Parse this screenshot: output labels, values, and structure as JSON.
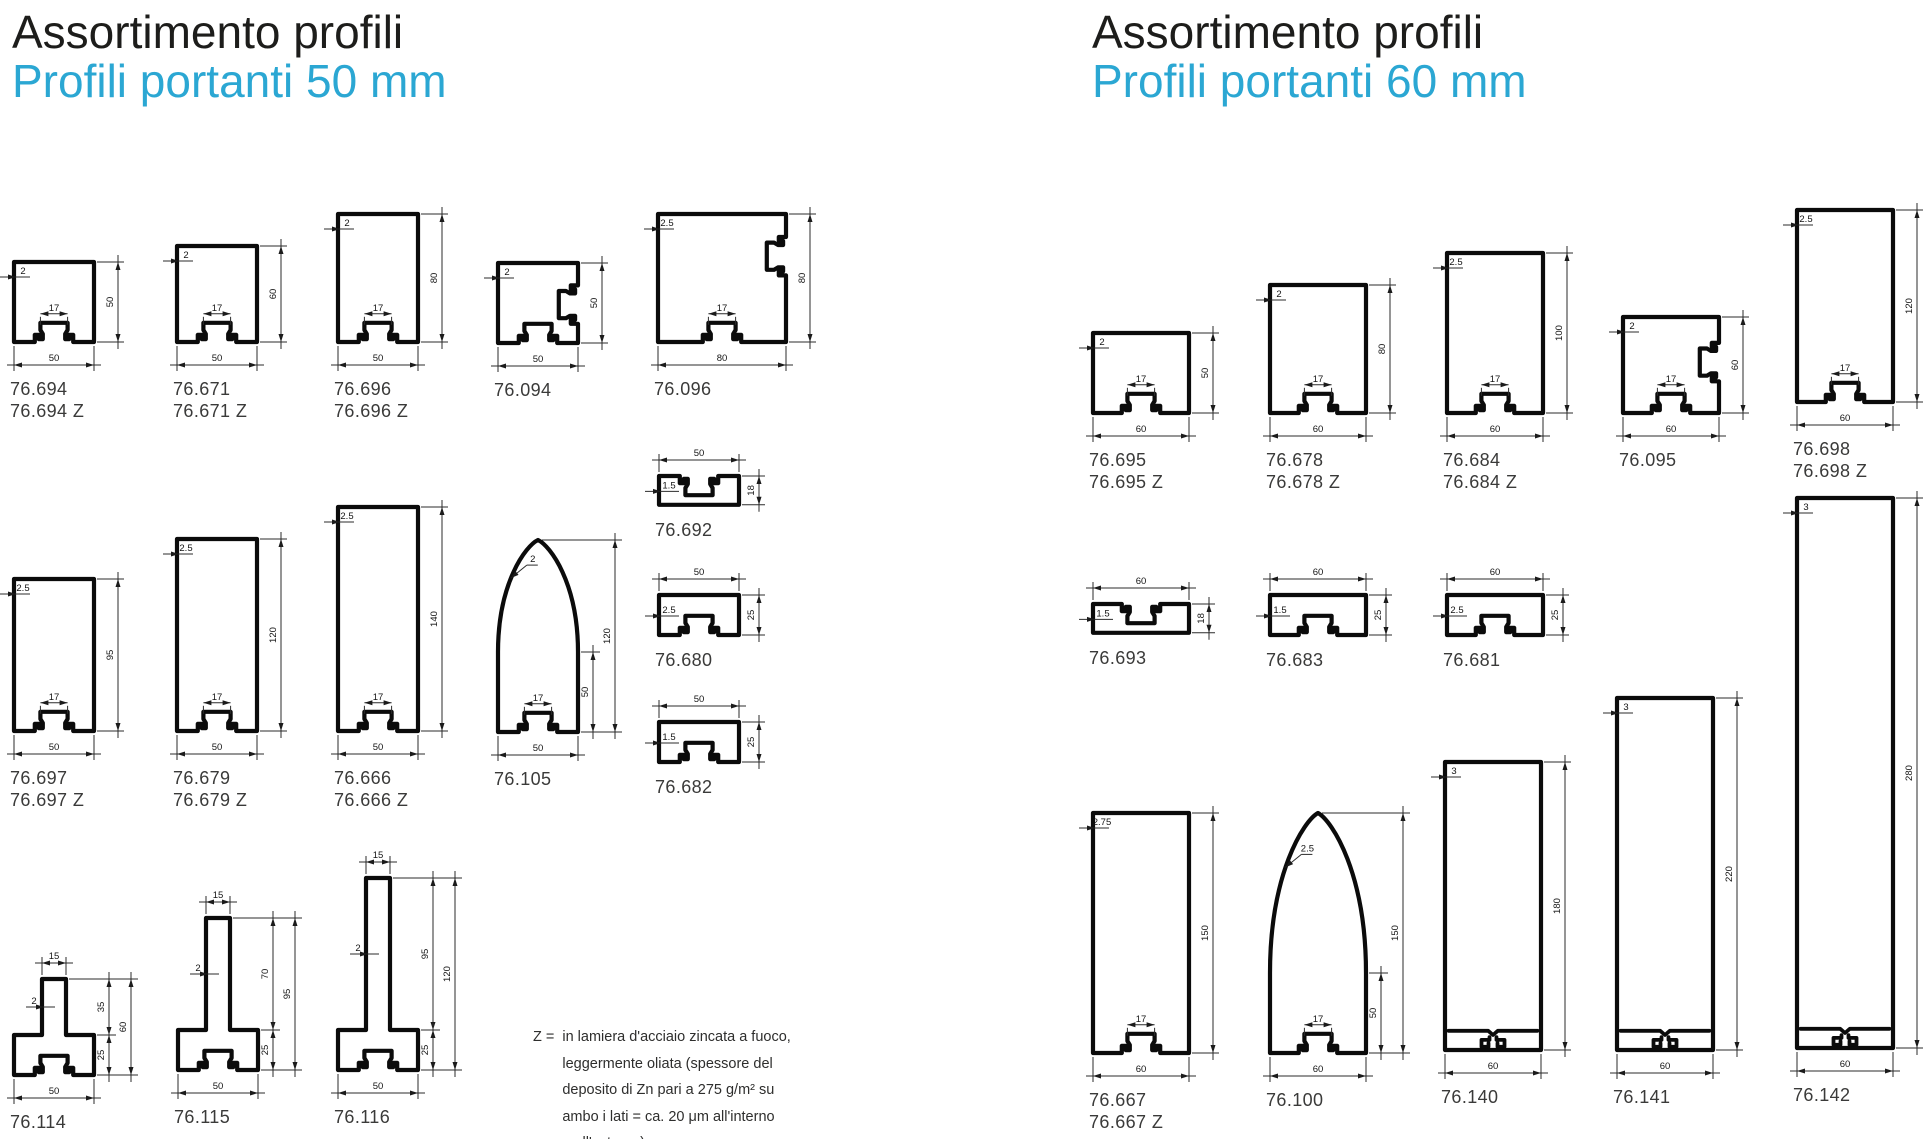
{
  "colors": {
    "accent": "#2ba7d3",
    "title": "#1d1d1b",
    "line": "#0b0b0b",
    "label": "#3a3a39"
  },
  "sections": [
    {
      "title": "Assortimento profili",
      "subtitle": "Profili portanti 50 mm",
      "profiles": [
        {
          "id": "76.694",
          "labels": [
            "76.694",
            "76.694 Z"
          ],
          "shape": "channel",
          "w": 50,
          "h": 50,
          "t": 2,
          "slot": 17
        },
        {
          "id": "76.671",
          "labels": [
            "76.671",
            "76.671 Z"
          ],
          "shape": "channel",
          "w": 50,
          "h": 60,
          "t": 2,
          "slot": 17
        },
        {
          "id": "76.696",
          "labels": [
            "76.696",
            "76.696 Z"
          ],
          "shape": "channel",
          "w": 50,
          "h": 80,
          "t": 2,
          "slot": 17
        },
        {
          "id": "76.094",
          "labels": [
            "76.094"
          ],
          "shape": "channel-side",
          "w": 50,
          "h": 50,
          "t": 2
        },
        {
          "id": "76.096",
          "labels": [
            "76.096"
          ],
          "shape": "channel-side",
          "w": 80,
          "h": 80,
          "t": 2.5,
          "slot": 17
        },
        {
          "id": "76.697",
          "labels": [
            "76.697",
            "76.697 Z"
          ],
          "shape": "channel",
          "w": 50,
          "h": 95,
          "t": 2.5,
          "slot": 17
        },
        {
          "id": "76.679",
          "labels": [
            "76.679",
            "76.679 Z"
          ],
          "shape": "channel",
          "w": 50,
          "h": 120,
          "t": 2.5,
          "slot": 17
        },
        {
          "id": "76.666",
          "labels": [
            "76.666",
            "76.666 Z"
          ],
          "shape": "channel",
          "w": 50,
          "h": 140,
          "t": 2.5,
          "slot": 17
        },
        {
          "id": "76.105",
          "labels": [
            "76.105"
          ],
          "shape": "ogive",
          "w": 50,
          "h": 120,
          "t": 2,
          "slot": 17,
          "straight": 50
        },
        {
          "id": "76.692",
          "labels": [
            "76.692"
          ],
          "shape": "flat-top",
          "w": 50,
          "h": 18,
          "t": 1.5
        },
        {
          "id": "76.680",
          "labels": [
            "76.680"
          ],
          "shape": "flat-bottom",
          "w": 50,
          "h": 25,
          "t": 2.5
        },
        {
          "id": "76.682",
          "labels": [
            "76.682"
          ],
          "shape": "flat-bottom",
          "w": 50,
          "h": 25,
          "t": 1.5
        },
        {
          "id": "76.114",
          "labels": [
            "76.114"
          ],
          "shape": "tee",
          "w": 50,
          "h": 60,
          "t": 2,
          "stem": 15,
          "stem_h": 35,
          "base_h": 25
        },
        {
          "id": "76.115",
          "labels": [
            "76.115"
          ],
          "shape": "tee",
          "w": 50,
          "h": 95,
          "t": 2,
          "stem": 15,
          "stem_h": 70,
          "base_h": 25
        },
        {
          "id": "76.116",
          "labels": [
            "76.116"
          ],
          "shape": "tee",
          "w": 50,
          "h": 120,
          "t": 2,
          "stem": 15,
          "stem_h": 95,
          "base_h": 25
        }
      ]
    },
    {
      "title": "Assortimento profili",
      "subtitle": "Profili portanti 60 mm",
      "profiles": [
        {
          "id": "76.695",
          "labels": [
            "76.695",
            "76.695 Z"
          ],
          "shape": "channel",
          "w": 60,
          "h": 50,
          "t": 2,
          "slot": 17
        },
        {
          "id": "76.678",
          "labels": [
            "76.678",
            "76.678 Z"
          ],
          "shape": "channel",
          "w": 60,
          "h": 80,
          "t": 2,
          "slot": 17
        },
        {
          "id": "76.684",
          "labels": [
            "76.684",
            "76.684 Z"
          ],
          "shape": "channel",
          "w": 60,
          "h": 100,
          "t": 2.5,
          "slot": 17
        },
        {
          "id": "76.095",
          "labels": [
            "76.095"
          ],
          "shape": "channel-side",
          "w": 60,
          "h": 60,
          "t": 2,
          "slot": 17
        },
        {
          "id": "76.698",
          "labels": [
            "76.698",
            "76.698 Z"
          ],
          "shape": "channel",
          "w": 60,
          "h": 120,
          "t": 2.5,
          "slot": 17
        },
        {
          "id": "76.693",
          "labels": [
            "76.693"
          ],
          "shape": "flat-top",
          "w": 60,
          "h": 18,
          "t": 1.5
        },
        {
          "id": "76.683",
          "labels": [
            "76.683"
          ],
          "shape": "flat-bottom",
          "w": 60,
          "h": 25,
          "t": 1.5
        },
        {
          "id": "76.681",
          "labels": [
            "76.681"
          ],
          "shape": "flat-bottom",
          "w": 60,
          "h": 25,
          "t": 2.5
        },
        {
          "id": "76.667",
          "labels": [
            "76.667",
            "76.667 Z"
          ],
          "shape": "channel",
          "w": 60,
          "h": 150,
          "t": 2.75,
          "slot": 17
        },
        {
          "id": "76.100",
          "labels": [
            "76.100"
          ],
          "shape": "ogive",
          "w": 60,
          "h": 150,
          "t": 2.5,
          "slot": 17,
          "straight": 50
        },
        {
          "id": "76.140",
          "labels": [
            "76.140"
          ],
          "shape": "closed",
          "w": 60,
          "h": 180,
          "t": 3
        },
        {
          "id": "76.141",
          "labels": [
            "76.141"
          ],
          "shape": "closed",
          "w": 60,
          "h": 220,
          "t": 3
        },
        {
          "id": "76.142",
          "labels": [
            "76.142"
          ],
          "shape": "closed",
          "w": 60,
          "h": 280,
          "t": 3
        }
      ]
    }
  ],
  "footnote": {
    "prefix": "Z =",
    "lines": [
      "in lamiera d'acciaio zincata a fuoco,",
      "leggermente oliata (spessore del",
      "deposito di Zn pari a 275 g/m² su",
      "ambo i lati = ca. 20 μm all'interno",
      "e all'esterno)"
    ]
  }
}
